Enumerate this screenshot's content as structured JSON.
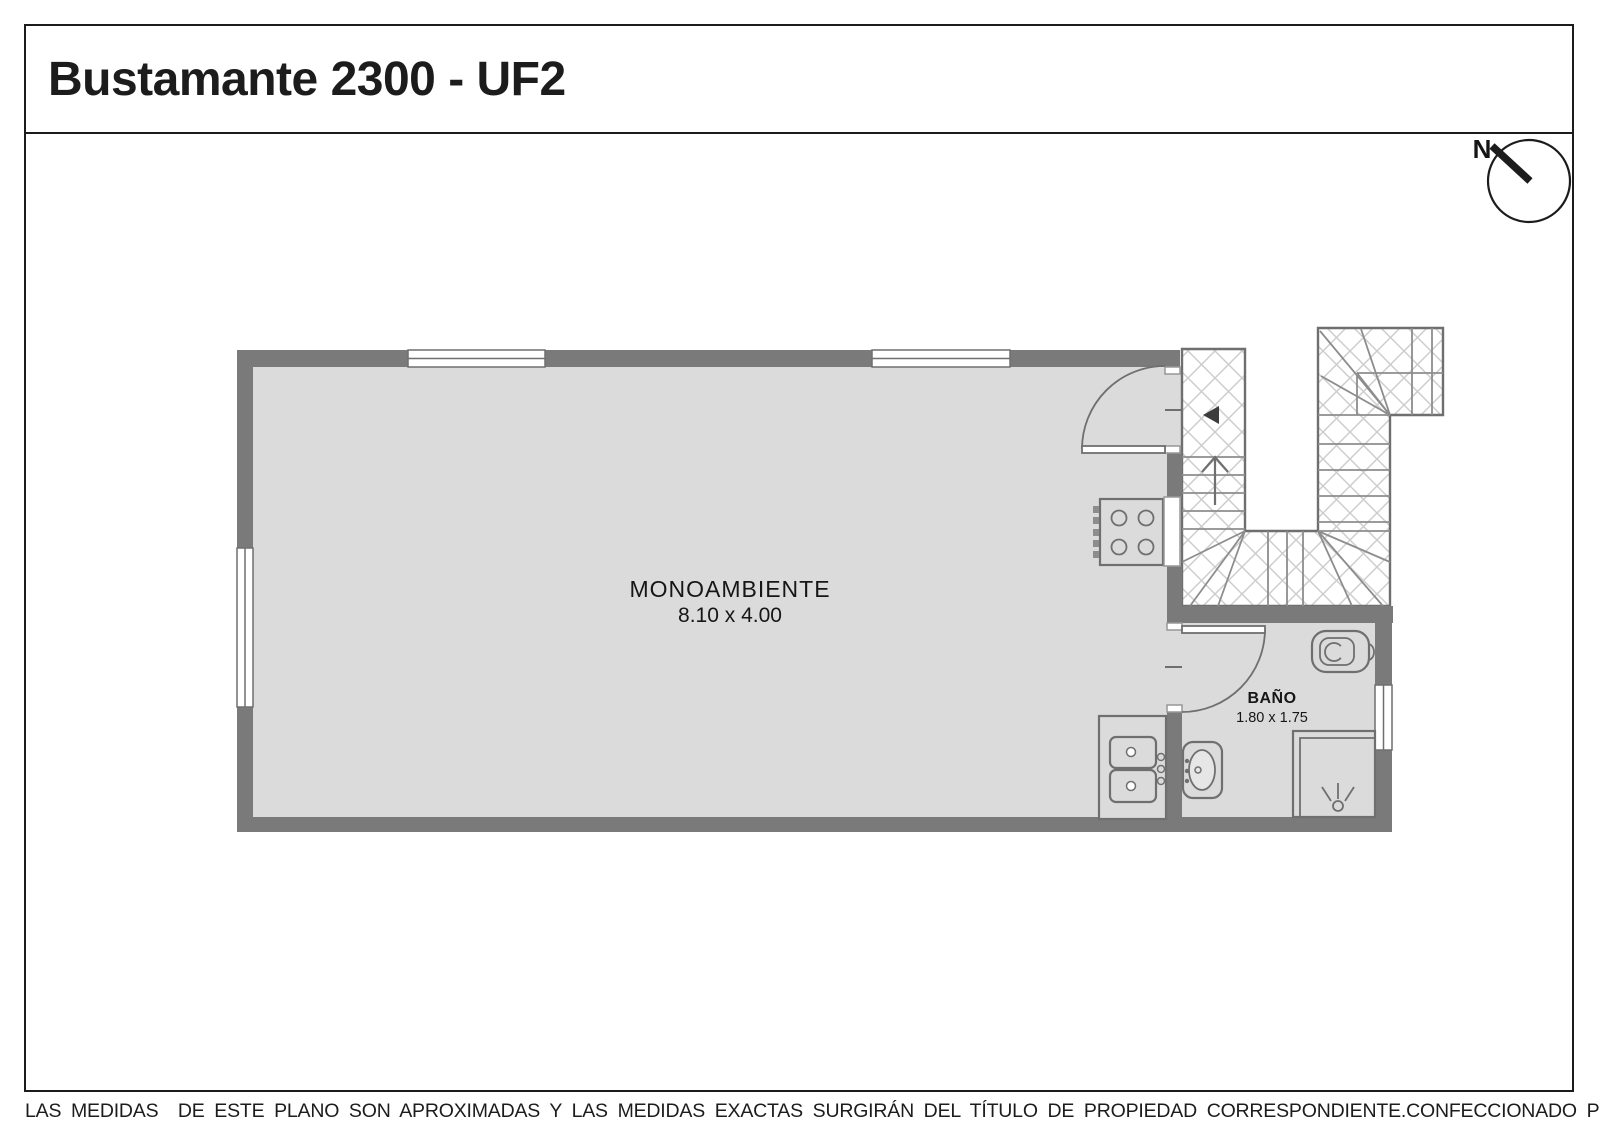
{
  "header": {
    "title": "Bustamante 2300 - UF2"
  },
  "compass": {
    "label": "N"
  },
  "plan": {
    "rooms": [
      {
        "name": "MONOAMBIENTE",
        "dimensions": "8.10 x 4.00"
      },
      {
        "name": "BAÑO",
        "dimensions": "1.80 x 1.75"
      }
    ]
  },
  "footer": {
    "disclaimer": "LAS MEDIDAS  DE ESTE PLANO SON APROXIMADAS Y LAS MEDIDAS EXACTAS SURGIRÁN DEL TÍTULO DE PROPIEDAD CORRESPONDIENTE.",
    "credit": "CONFECCIONADO POR ESTUDIO NARTEX"
  },
  "colors": {
    "ink": "#1c1c1c",
    "wall": "#7a7a7a",
    "floor": "#dbdbdb",
    "line": "#6f6f6f",
    "hatch": "#cdcdcd"
  }
}
